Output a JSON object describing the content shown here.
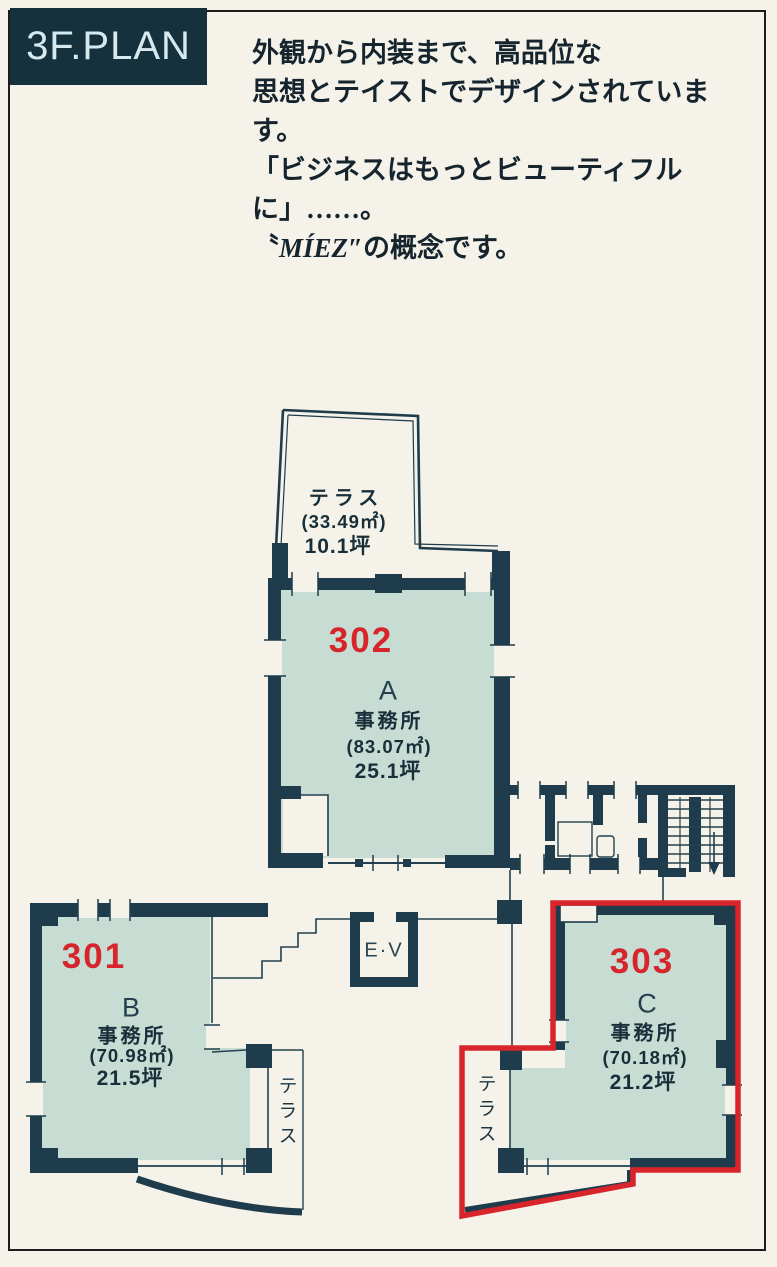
{
  "header": {
    "title": "3F.PLAN"
  },
  "intro": {
    "line1": "外観から内装まで、高品位な",
    "line2": "思想とテイストでデザインされています。",
    "line3": "「ビジネスはもっとビューティフルに」……。",
    "line4_open": "〝",
    "line4_brand": "MÍEZ",
    "line4_rest": "″の概念です。"
  },
  "plan": {
    "terrace_top": {
      "label": "テラス",
      "area_m2": "(33.49㎡)",
      "area_tsubo": "10.1坪"
    },
    "unit_a": {
      "number": "302",
      "letter": "A",
      "type": "事務所",
      "area_m2": "(83.07㎡)",
      "area_tsubo": "25.1坪"
    },
    "unit_b": {
      "number": "301",
      "letter": "B",
      "type": "事務所",
      "area_m2": "(70.98㎡)",
      "area_tsubo": "21.5坪"
    },
    "unit_c": {
      "number": "303",
      "letter": "C",
      "type": "事務所",
      "area_m2": "(70.18㎡)",
      "area_tsubo": "21.2坪"
    },
    "terrace_b": {
      "label": "テラス"
    },
    "terrace_c": {
      "label": "テラス"
    },
    "elevator": {
      "label": "E·V"
    }
  },
  "colors": {
    "wall": "#1e3c4b",
    "room_fill": "#c7dcd3",
    "highlight_red": "#d8242b",
    "header_bg": "#15313d",
    "page_bg": "#f5f3e9"
  }
}
